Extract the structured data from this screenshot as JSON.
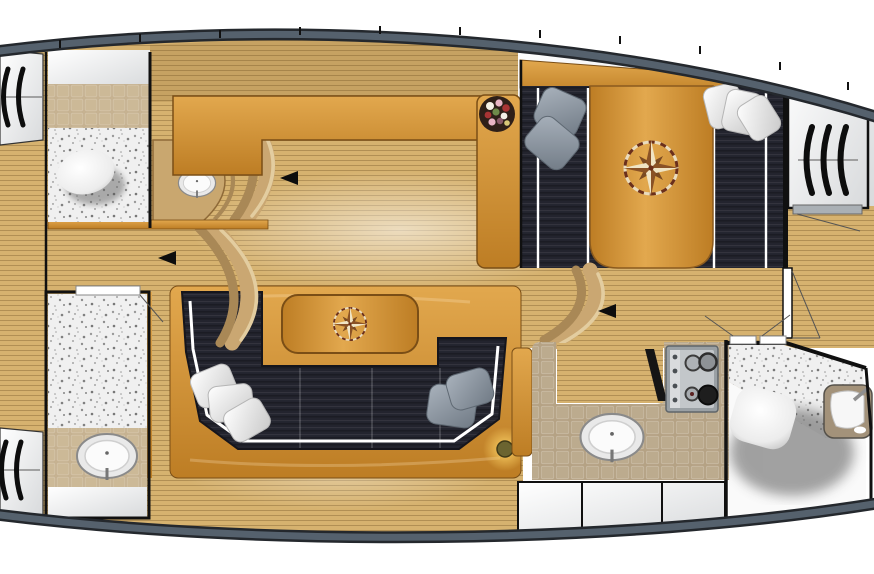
{
  "meta": {
    "view": "yacht interior deck plan, top view",
    "width": 874,
    "height": 574
  },
  "palette": {
    "deckWhite": "#ffffff",
    "deckShade": "#d8dadc",
    "hullBand": "#55616d",
    "hullEdge": "#24282d",
    "wall": "#101010",
    "floorWood": "#d6b26f",
    "floorLine": "#7a5a2a",
    "cabinetLight": "#e2a84e",
    "cabinetDark": "#bd7d24",
    "cabinetEdge": "#7a4e16",
    "upholstery": "#23242e",
    "upholsteryDeep": "#15151c",
    "piping": "#ffffff",
    "tileGalley": "#b5a284",
    "tileWall": "#c6b291",
    "speckleBase": "#f0f0f0",
    "arcTan": "#caa772",
    "arcTanDark": "#a98856",
    "arcTanLight": "#e3cda0",
    "pillowWhite": "#f4f4f4",
    "pillowGray": "#8d98a3",
    "steel": "#c3c7ca",
    "steelFrame": "#9aa0a4",
    "basin": "#f4f4f4",
    "thresholdGray": "#aab0b5",
    "glowHalo": "#ffd76a",
    "glowCore": "#6b6430",
    "compassDark": "#7a4a22",
    "compassLight": "#f0e4c4",
    "flowerBase": "#2e1f18"
  },
  "fixtures": {
    "compass_roses": 2,
    "sinks": 3,
    "toilets": 2,
    "stove_burners": 4,
    "stove_knobs": 4,
    "direction_arrows": 3,
    "white_pillows": 6,
    "gray_pillows": 4,
    "hatch_glyphs": 3,
    "flower_pot": 1,
    "ceiling_light": 1,
    "locker_doors_bottom": 3
  },
  "icons": {
    "hatch": "step-hatch-icon (curved louver strokes)",
    "arrow": "direction-arrow-icon (solid left triangle)",
    "compass": "compass-rose-icon",
    "plant": "flower-pot-icon"
  }
}
